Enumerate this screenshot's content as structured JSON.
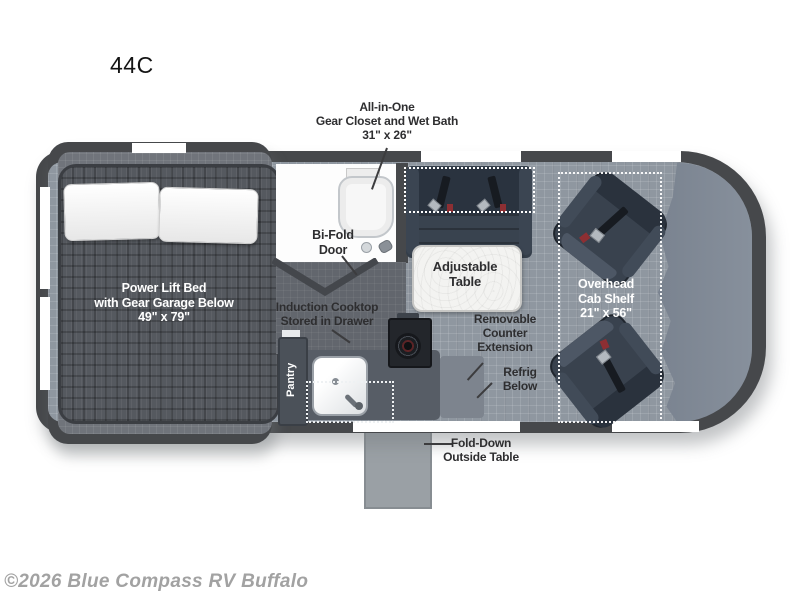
{
  "title": "44C",
  "watermark": "©2026 Blue Compass RV Buffalo",
  "colors": {
    "wall": "#46484b",
    "floor": "#8f97a0",
    "bed_mattress": "#55595f",
    "seat_upholstery": "#39424e",
    "bathroom": "#fdfdfd",
    "table_top": "#f3f3f1",
    "counter": "#575d66",
    "outside_table": "#9aa0a5",
    "seatbelt_red": "#8d2f33",
    "label_text": "#2e2e30",
    "label_text_light": "#ffffff",
    "watermark_text": "#a2a2a2"
  },
  "labels": {
    "gear_closet": {
      "lines": [
        "All-in-One",
        "Gear Closet and Wet Bath",
        "31\" x 26\""
      ]
    },
    "bifold": {
      "lines": [
        "Bi-Fold",
        "Door"
      ]
    },
    "bed": {
      "lines": [
        "Power Lift Bed",
        "with Gear Garage Below",
        "49\" x 79\""
      ]
    },
    "induction": {
      "lines": [
        "Induction Cooktop",
        "Stored in Drawer"
      ]
    },
    "table": {
      "lines": [
        "Adjustable",
        "Table"
      ]
    },
    "shelf": {
      "lines": [
        "Overhead",
        "Cab Shelf",
        "21\" x 56\""
      ]
    },
    "counter_ext": {
      "lines": [
        "Removable",
        "Counter",
        "Extension"
      ]
    },
    "refrig": {
      "lines": [
        "Refrig",
        "Below"
      ]
    },
    "outside_table": {
      "lines": [
        "Fold-Down",
        "Outside Table"
      ]
    },
    "pantry": "Pantry"
  }
}
